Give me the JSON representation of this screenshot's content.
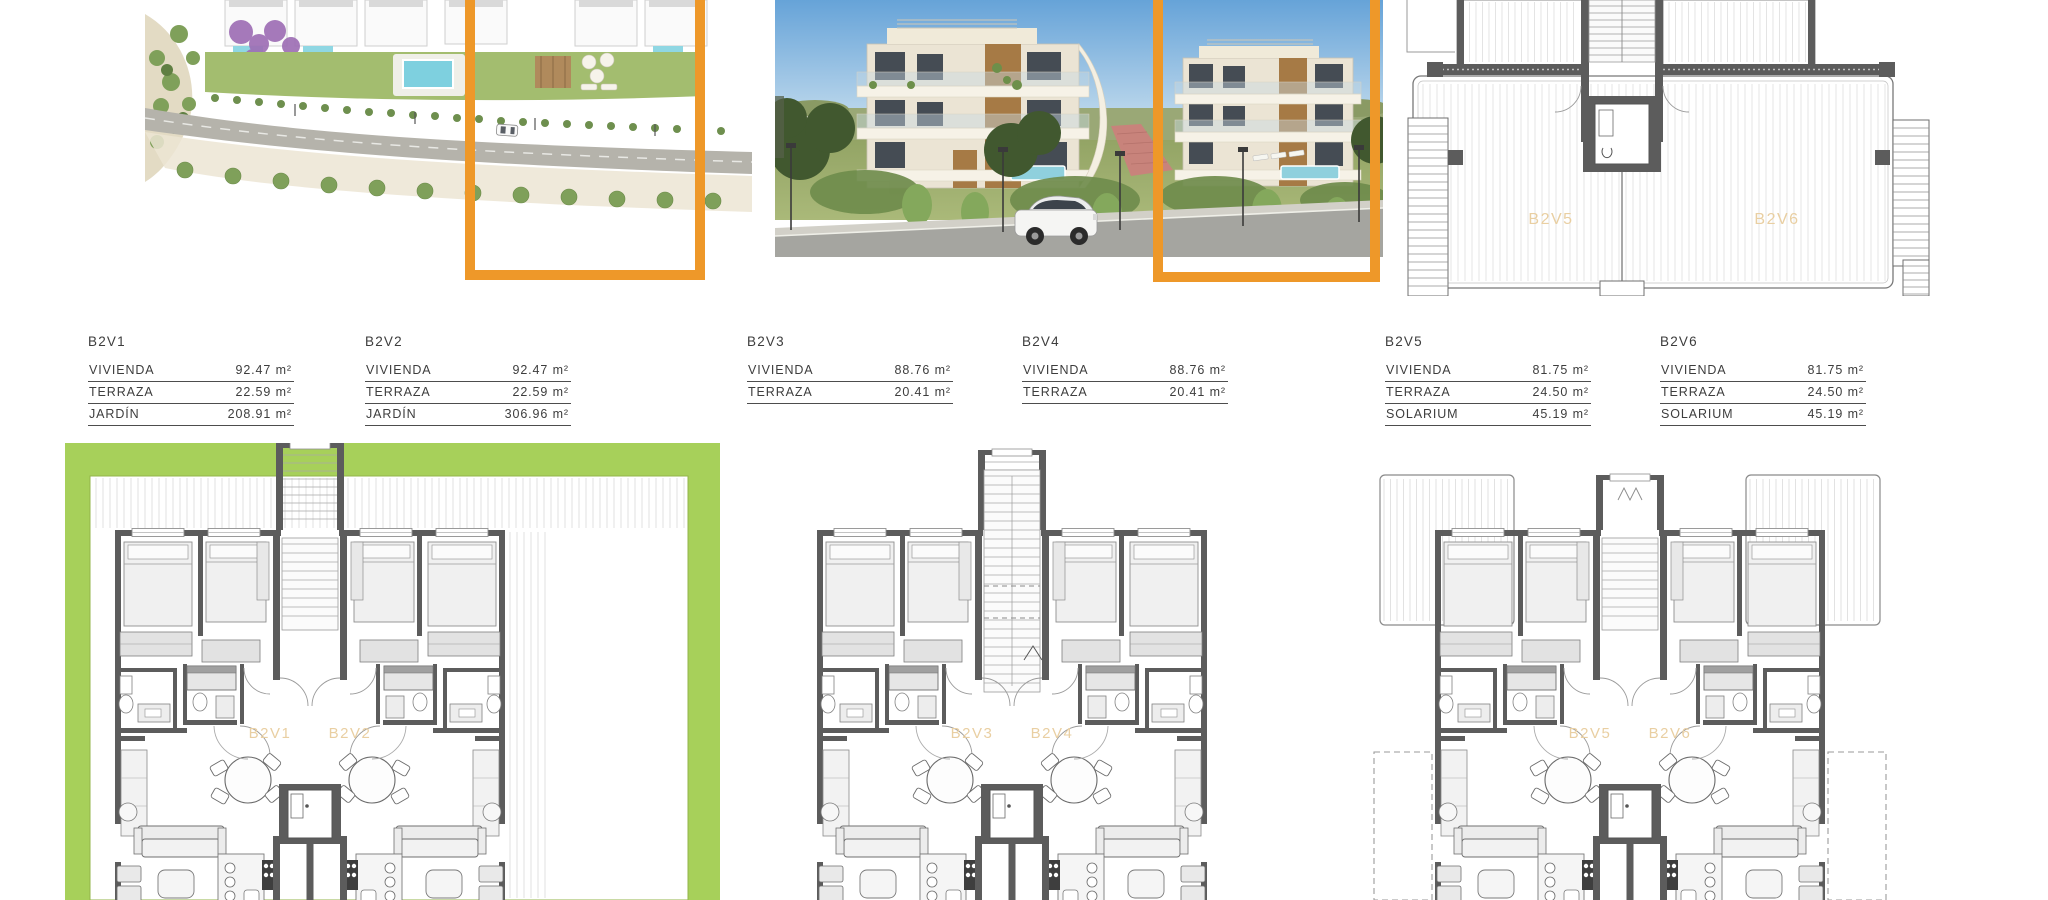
{
  "units": [
    {
      "id": "B2V1",
      "rows": [
        {
          "label": "VIVIENDA",
          "value": "92.47 m²"
        },
        {
          "label": "TERRAZA",
          "value": "22.59 m²"
        },
        {
          "label": "JARDÍN",
          "value": "208.91 m²"
        }
      ]
    },
    {
      "id": "B2V2",
      "rows": [
        {
          "label": "VIVIENDA",
          "value": "92.47 m²"
        },
        {
          "label": "TERRAZA",
          "value": "22.59 m²"
        },
        {
          "label": "JARDÍN",
          "value": "306.96 m²"
        }
      ]
    },
    {
      "id": "B2V3",
      "rows": [
        {
          "label": "VIVIENDA",
          "value": "88.76 m²"
        },
        {
          "label": "TERRAZA",
          "value": "20.41 m²"
        }
      ]
    },
    {
      "id": "B2V4",
      "rows": [
        {
          "label": "VIVIENDA",
          "value": "88.76 m²"
        },
        {
          "label": "TERRAZA",
          "value": "20.41 m²"
        }
      ]
    },
    {
      "id": "B2V5",
      "rows": [
        {
          "label": "VIVIENDA",
          "value": "81.75 m²"
        },
        {
          "label": "TERRAZA",
          "value": "24.50 m²"
        },
        {
          "label": "SOLARIUM",
          "value": "45.19 m²"
        }
      ]
    },
    {
      "id": "B2V6",
      "rows": [
        {
          "label": "VIVIENDA",
          "value": "81.75 m²"
        },
        {
          "label": "TERRAZA",
          "value": "24.50 m²"
        },
        {
          "label": "SOLARIUM",
          "value": "45.19 m²"
        }
      ]
    }
  ],
  "floor_plans": [
    {
      "labels": [
        "B2V1",
        "B2V2"
      ],
      "variant": "garden"
    },
    {
      "labels": [
        "B2V3",
        "B2V4"
      ],
      "variant": "stair"
    },
    {
      "labels": [
        "B2V5",
        "B2V6"
      ],
      "variant": "terraces"
    }
  ],
  "roof_plan": {
    "labels": [
      "B2V5",
      "B2V6"
    ]
  },
  "colors": {
    "highlight_orange": "#EE9829",
    "garden_green": "#A7D05A",
    "wall_gray": "#5C5C5C",
    "plan_label_tan": "#E9CFA2",
    "deck_hatch": "#DADADA"
  }
}
